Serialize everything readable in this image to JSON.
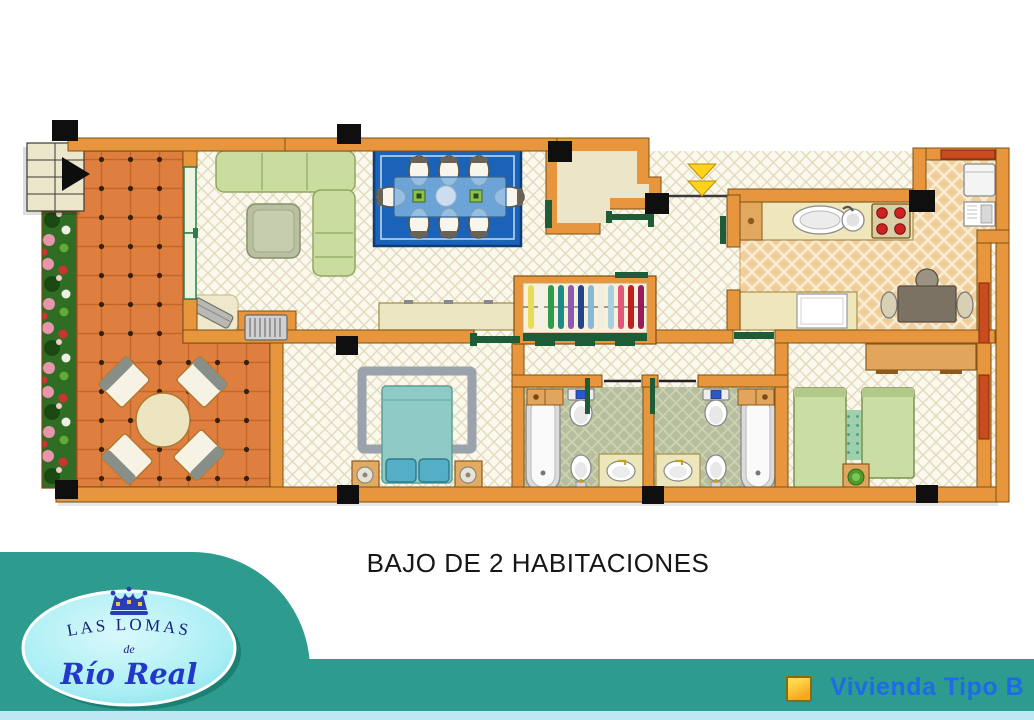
{
  "title": "BAJO DE 2 HABITACIONES",
  "legend": {
    "label": "Vivienda Tipo B"
  },
  "logo": {
    "name_top": "LAS LOMAS",
    "name_mid": "de",
    "name_script": "Río Real"
  },
  "palette": {
    "page_bg": "#FFFFFF",
    "teal": "#2E9B8F",
    "strip": "#BDE7F3",
    "title_color": "#161616",
    "legend_blue": "#1E6BE8",
    "swatch_orange": "#F6A81C",
    "wall": "#E8963E",
    "wall_edge": "#7A5213",
    "terrace_tile": "#DF7F3F",
    "door_green": "#1E5C38",
    "window_red": "#C94B20",
    "logo_navy": "#18227E",
    "logo_script_blue": "#2337C8"
  },
  "plan": {
    "name": "floor-plan",
    "rooms": [
      "terrace",
      "living-room",
      "dining-area",
      "entrance-hall",
      "kitchen",
      "corridor",
      "master-bedroom",
      "bathroom-1",
      "bathroom-2",
      "bedroom-2"
    ],
    "furniture": [
      "stairs",
      "flower-bed",
      "terrace-table",
      "terrace-chairs",
      "corner-sofa",
      "coffee-table",
      "dining-rug",
      "dining-table",
      "dining-chairs",
      "sideboard",
      "radiator",
      "glass-doors",
      "wardrobe",
      "kitchen-counter",
      "kitchen-sink",
      "stove",
      "fridge",
      "washing-machine",
      "kitchen-table",
      "dresser",
      "double-bed",
      "nightstands",
      "bathtubs",
      "toilets",
      "bidets",
      "washbasins",
      "single-beds",
      "bedside-rug",
      "plant"
    ]
  }
}
